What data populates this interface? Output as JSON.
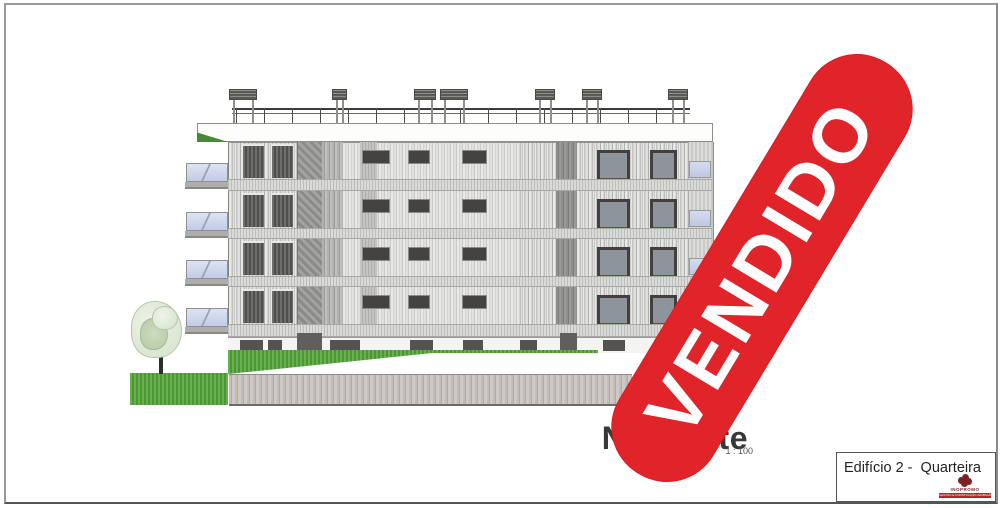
{
  "drawing": {
    "elevation_label": {
      "title": "Nascente",
      "scale": "1 : 100"
    },
    "stamp": {
      "text": "VENDIDO",
      "color": "#e1242a"
    },
    "title_block": {
      "project": "Edifício 2 -  Quarteira",
      "logo_name": "INOPROMO",
      "logo_tagline": "GESTÃO E CONSTRUÇÃO IMOBILIÁRIA"
    },
    "colors": {
      "stamp_red": "#e1242a",
      "grass_green": "#52a437",
      "wall_gray": "#bcb6b2",
      "balcony_glass_blue": "#ccd4ea",
      "logo_red": "#7d2125"
    }
  }
}
